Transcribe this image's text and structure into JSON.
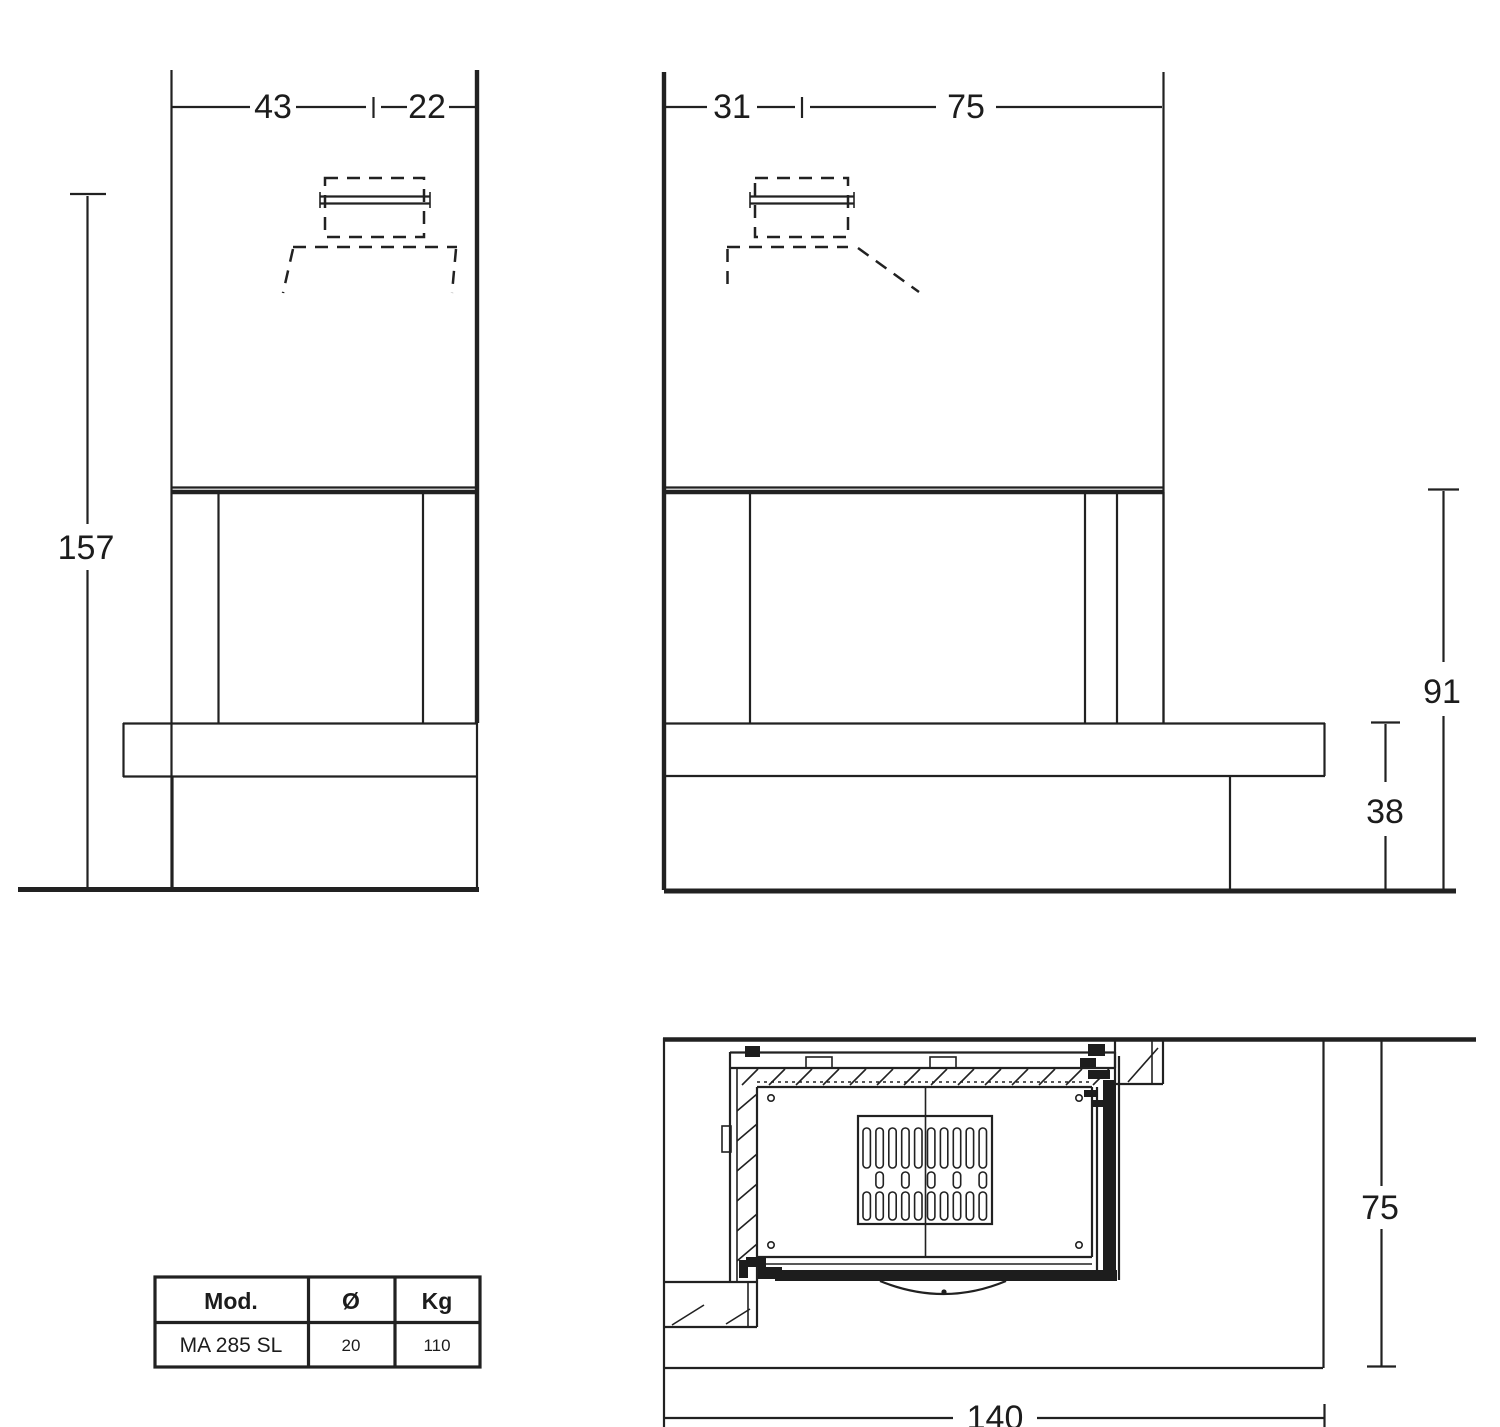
{
  "views": {
    "front": {
      "width_left": "43",
      "width_right": "22",
      "height": "157"
    },
    "side": {
      "depth_front": "31",
      "depth_back": "75",
      "opening_height": "91",
      "bench_height": "38"
    },
    "plan": {
      "depth": "75",
      "width": "140"
    }
  },
  "table": {
    "headers": [
      "Mod.",
      "Ø",
      "Kg"
    ],
    "rows": [
      [
        "MA 285 SL",
        "20",
        "110"
      ]
    ]
  },
  "colors": {
    "line": "#212121",
    "background": "#ffffff"
  }
}
